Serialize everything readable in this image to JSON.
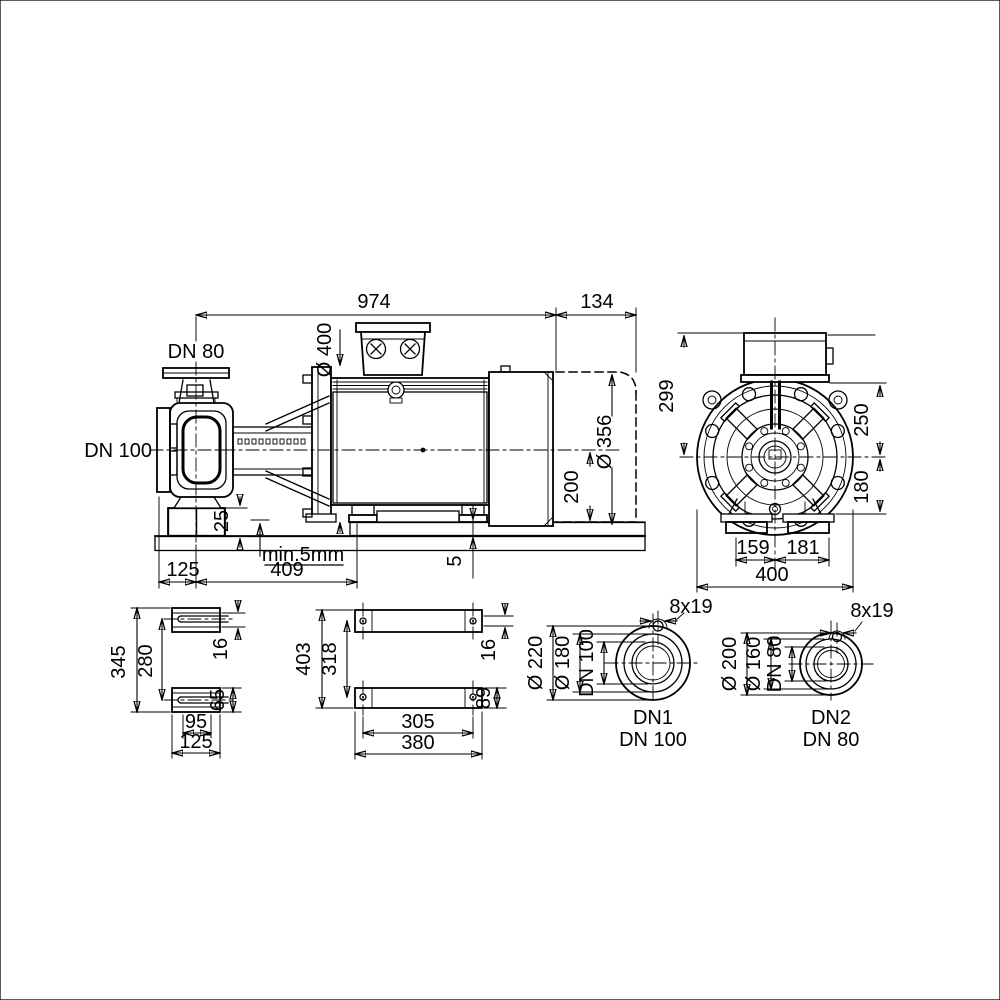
{
  "colors": {
    "background": "#ffffff",
    "line": "#000000",
    "shading": "#8a8a8a"
  },
  "side_view": {
    "total_length": "974",
    "extension_length": "134",
    "discharge_flange": "DN 80",
    "suction_flange": "DN 100",
    "motor_flange_diameter": "Ø 400",
    "motor_diameter": "Ø 356",
    "shaft_height": "200",
    "plinth_height": "25",
    "grout_note": "min.5mm",
    "suction_offset": "125",
    "foot_distance": "409",
    "shim_height": "5"
  },
  "end_view": {
    "height_above_axis": "299",
    "top_half_width": "250",
    "bottom_half_width": "180",
    "foot_left_offset": "159",
    "foot_right_offset": "181",
    "total_width": "400"
  },
  "pump_foot_view": {
    "outer_length": "345",
    "hole_spacing": "280",
    "slot_width": "16",
    "foot_width": "65",
    "slot_spacing": "95",
    "foot_length": "125"
  },
  "motor_foot_view": {
    "outer_length": "403",
    "hole_spacing": "318",
    "slot_width": "16",
    "foot_width": "89",
    "hole_spacing_cross": "305",
    "outer_width": "380"
  },
  "flange_dn1": {
    "bolt_holes": "8x19",
    "outer_diameter": "Ø 220",
    "bolt_circle_diameter": "Ø 180",
    "nominal_bore": "DN 100",
    "port_label": "DN1",
    "port_size": "DN 100"
  },
  "flange_dn2": {
    "bolt_holes": "8x19",
    "outer_diameter": "Ø 200",
    "bolt_circle_diameter": "Ø 160",
    "nominal_bore": "DN 80",
    "port_label": "DN2",
    "port_size": "DN 80"
  }
}
